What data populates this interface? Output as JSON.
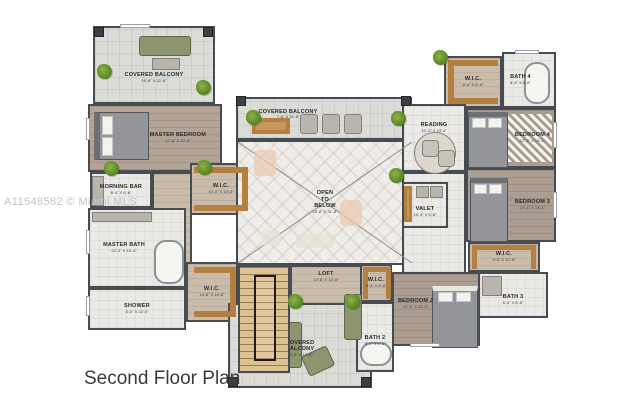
{
  "title": "Second Floor Plan",
  "watermark": "A11548582 © Miami MLS",
  "colors": {
    "wall": "#474b52",
    "wood_floor": "#b3a496",
    "tile_floor": "#eceae6",
    "paver_floor": "#dbdbd7",
    "closet_wood": "#b5803f",
    "stair_wood": "#ddc191",
    "plant_green": "#6b9a33",
    "sofa_olive": "#8d9470",
    "title_text": "#3b3b3b",
    "watermark_text": "#c2c2c2"
  },
  "rooms": {
    "covered_balcony_tl": {
      "name": "COVERED BALCONY",
      "dims": "16'-8\" X 22'-8\""
    },
    "master_bedroom": {
      "name": "MASTER BEDROOM",
      "dims": "17'-8\" X 22'-8\""
    },
    "morning_bar": {
      "name": "MORNING BAR",
      "dims": "8'-4\" X 6'-8\""
    },
    "wic_master": {
      "name": "W.I.C.",
      "dims": "10'-4\" X 13'-4\""
    },
    "master_bath": {
      "name": "MASTER BATH",
      "dims": "22'-4\" X 15'-4\""
    },
    "shower": {
      "name": "SHOWER",
      "dims": "8'-0\" X 22'-0\""
    },
    "wic_hall": {
      "name": "W.I.C.",
      "dims": "14'-8\" X 10'-8\""
    },
    "covered_balcony_top": {
      "name": "COVERED BALCONY",
      "dims": "7'-8\" X 31'-8\""
    },
    "open_to_below": {
      "name": "OPEN\nTO\nBELOW",
      "dims": "18'-8\" X 31'-8\""
    },
    "loft": {
      "name": "LOFT",
      "dims": "12'-8\" X 13'-8\""
    },
    "covered_balcony_bottom": {
      "name": "COVERED\nBALCONY",
      "dims": "12'-4\" X 13'-8\""
    },
    "wic_loft": {
      "name": "W.I.C.",
      "dims": "5'-4\" X 6'-8\""
    },
    "bath_2": {
      "name": "BATH 2",
      "dims": "8'-4\" X 6'-8\""
    },
    "bedroom_2": {
      "name": "BEDROOM 2",
      "dims": "14'-4\" X 13'-4\""
    },
    "reading": {
      "name": "READING",
      "dims": "10'-4\" X 13'-4\""
    },
    "valet": {
      "name": "VALET",
      "dims": "10'-4\" X 6'-8\""
    },
    "bedroom_4": {
      "name": "BEDROOM 4",
      "dims": "12'-4\" X 13'-4\""
    },
    "wic_4": {
      "name": "W.I.C.",
      "dims": "8'-4\" X 6'-8\""
    },
    "bath_4": {
      "name": "BATH 4",
      "dims": "8'-4\" X 6'-8\""
    },
    "bedroom_3": {
      "name": "BEDROOM 3",
      "dims": "12'-4\" X 13'-4\""
    },
    "wic_3": {
      "name": "W.I.C.",
      "dims": "5'-4\" X 10'-8\""
    },
    "bath_3": {
      "name": "BATH 3",
      "dims": "8'-4\" X 6'-8\""
    }
  }
}
